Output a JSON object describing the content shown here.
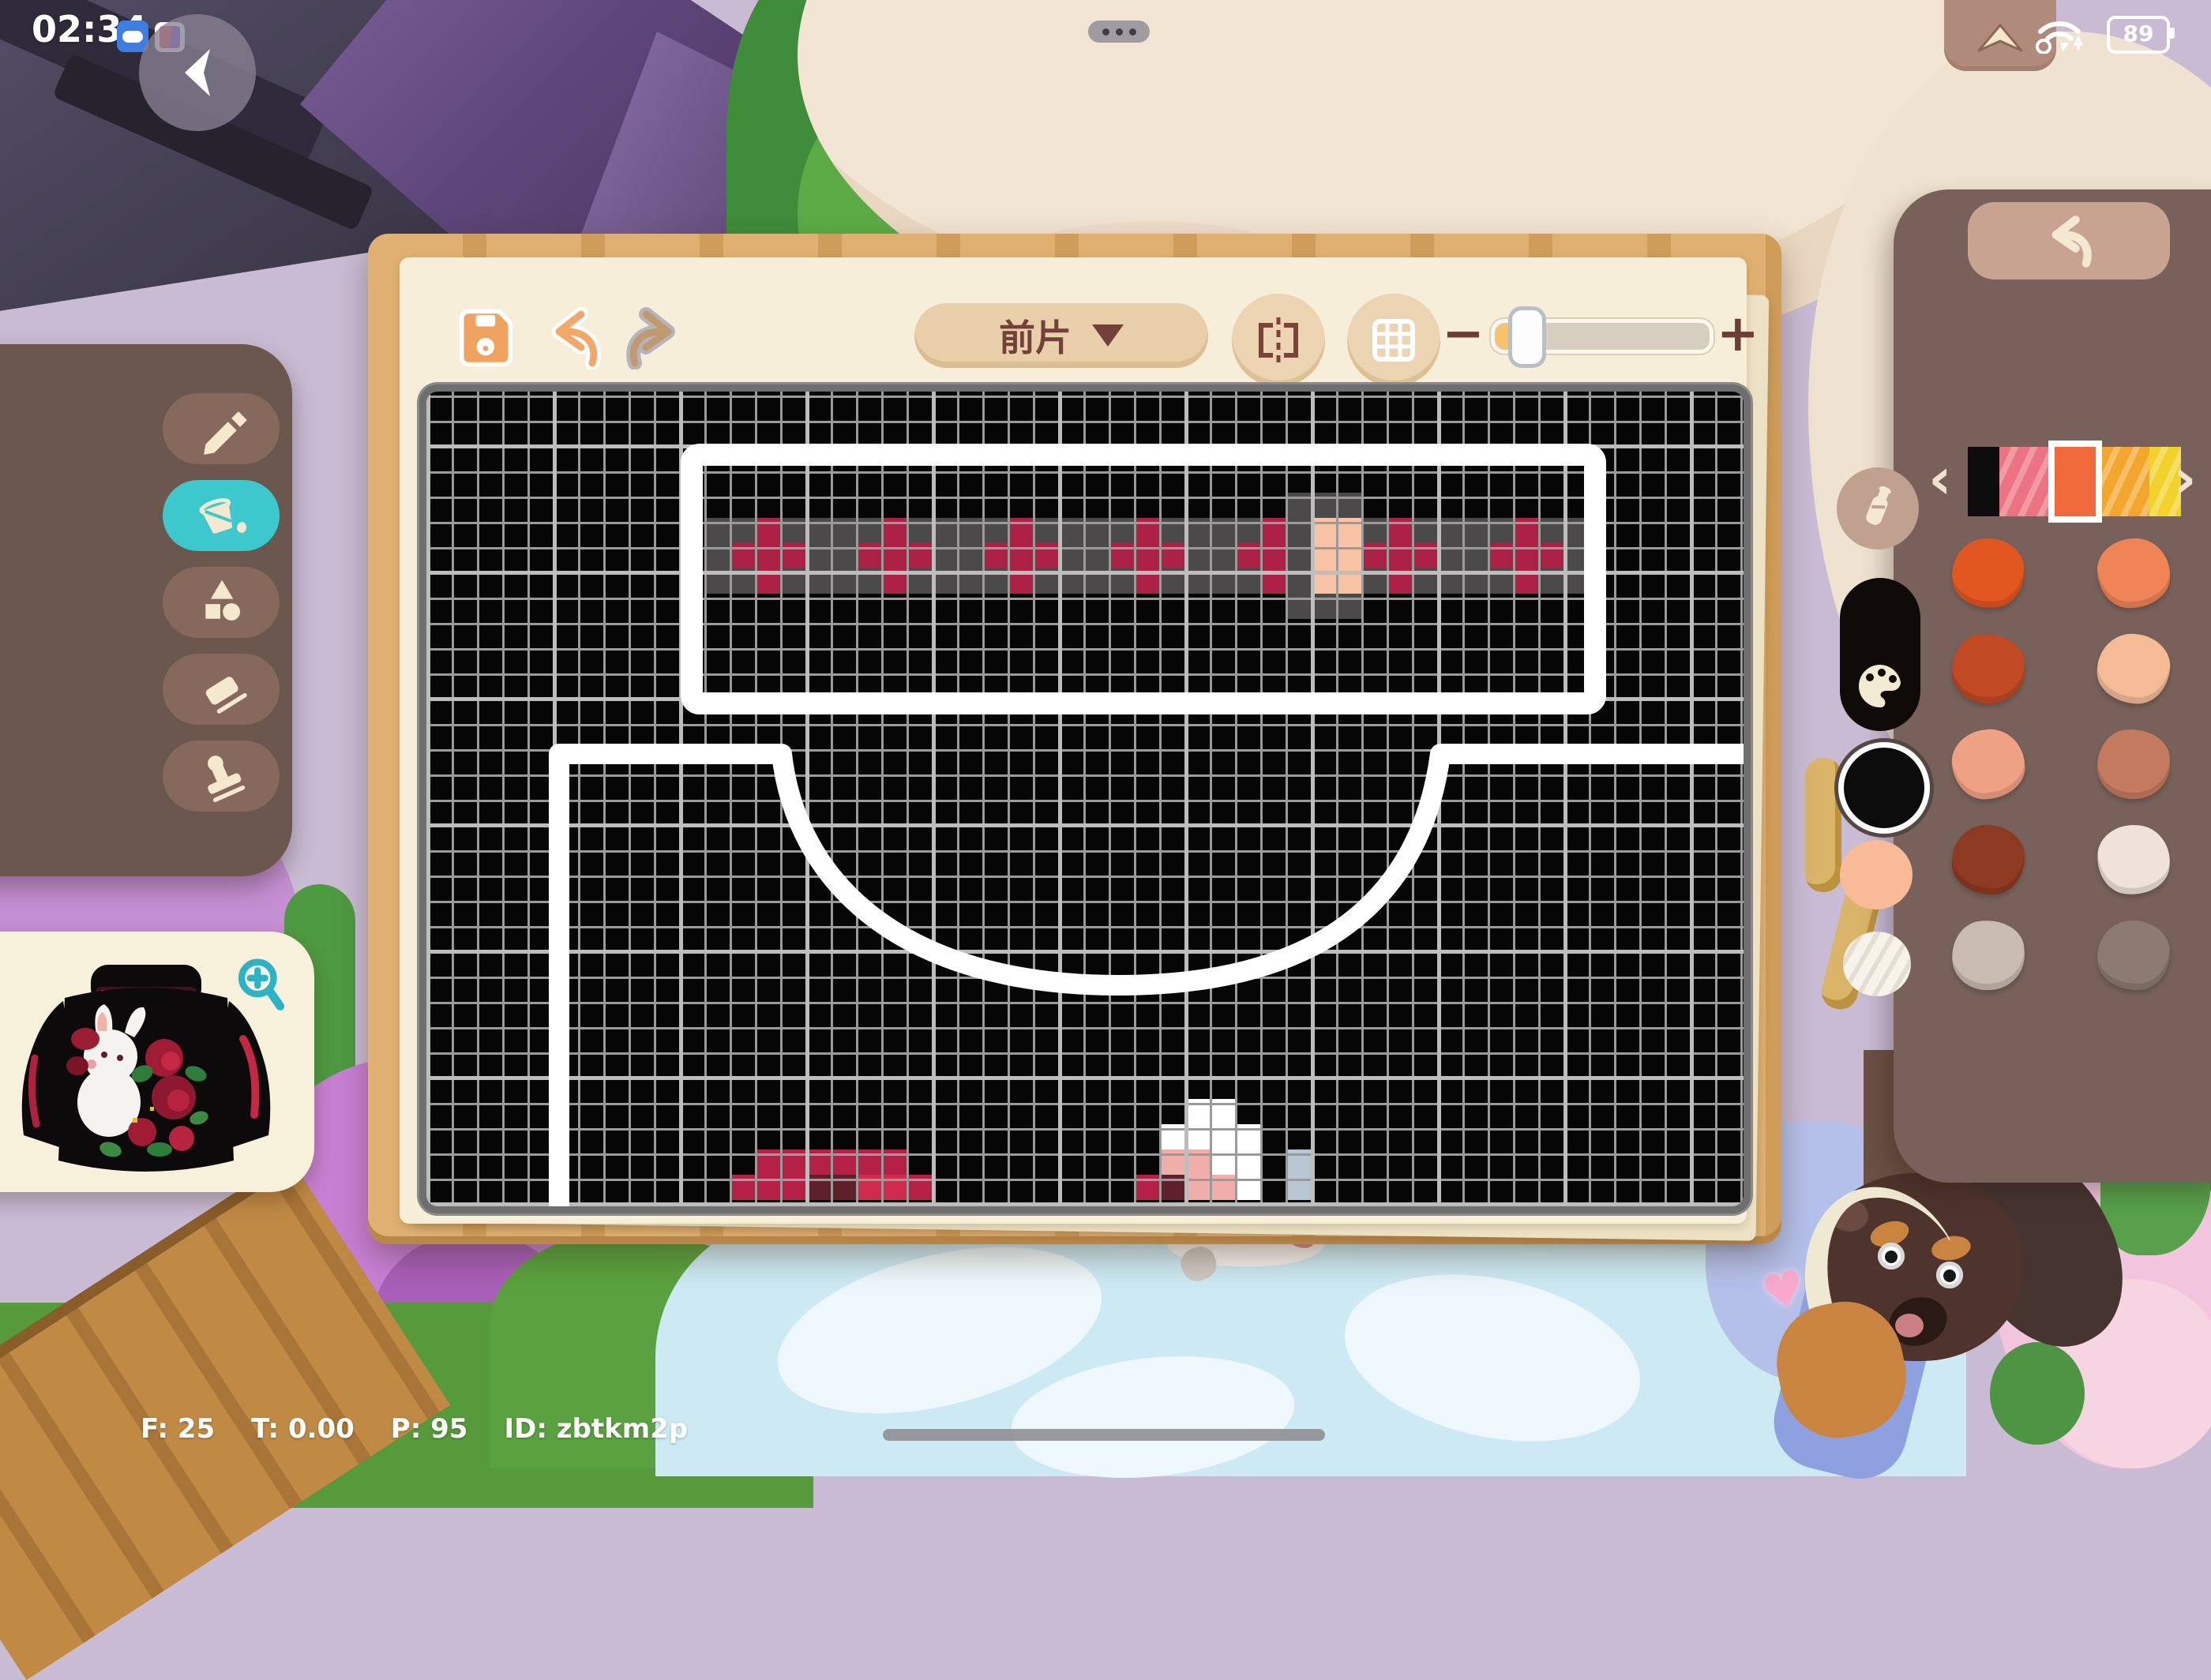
{
  "status_bar": {
    "clock": "02:34",
    "battery_percent": "89",
    "icons": [
      "cloud-app-icon",
      "book-app-icon",
      "back-arrow-icon",
      "multitask-dots-icon",
      "panel-up-icon",
      "wifi-icon",
      "battery-icon"
    ]
  },
  "toolbar": {
    "save_icon": "floppy-save-icon",
    "undo_icon": "undo-arrow-icon",
    "redo_icon": "redo-arrow-icon",
    "piece_selector": {
      "label": "前片",
      "icon": "chevron-down-triangle"
    },
    "mirror_icon": "mirror-symmetry-icon",
    "grid_icon": "grid-toggle-icon",
    "zoom_out_label": "−",
    "zoom_in_label": "+",
    "zoom_slider": {
      "value_fraction": 0.08
    }
  },
  "left_tools": {
    "items": [
      {
        "id": "pencil-tool",
        "selected": false
      },
      {
        "id": "bucket-tool",
        "selected": true
      },
      {
        "id": "shapes-tool",
        "selected": false
      },
      {
        "id": "eraser-tool",
        "selected": false
      },
      {
        "id": "stamp-tool",
        "selected": false
      }
    ],
    "selected_color": "#3cc8cd"
  },
  "preview": {
    "magnifier_icon": "zoom-in-magnifier",
    "subject": "black bunny rose sweater"
  },
  "right_panel": {
    "undo_icon": "undo-arrow-icon",
    "chevron_left": "‹",
    "chevron_right": "›",
    "strip": [
      {
        "color": "#0d0d0d",
        "selected": false,
        "striped": false,
        "w": 40
      },
      {
        "color": "#ec7381",
        "selected": false,
        "striped": true,
        "w": 62
      },
      {
        "color": "#f06a3c",
        "selected": true,
        "striped": false,
        "w": 68
      },
      {
        "color": "#f2a62e",
        "selected": false,
        "striped": true,
        "w": 60
      },
      {
        "color": "#f1d22b",
        "selected": false,
        "striped": true,
        "w": 40
      }
    ],
    "bottle_icon": "milk-bottle-icon",
    "palette_icon": "artist-palette-icon",
    "current_color": "#0c0c0c",
    "quick_colors": [
      "#f9ba97",
      "#f7f3ea"
    ],
    "swatches": [
      "#e2571f",
      "#ef8456",
      "#c14a24",
      "#f5bb97",
      "#efa183",
      "#c47a5e",
      "#8e3a22",
      "#eee2da",
      "#c9bab2",
      "#8d7b71"
    ]
  },
  "canvas": {
    "cell": 32,
    "cols": 52,
    "rows": 32,
    "palette": {
      "g": "#4b4949",
      "r": "#ac2145",
      "p": "#f7c3a4",
      "c": "#b52046",
      "m": "#5f1f2b",
      "b": "#d02a4e",
      "w": "#ffffff",
      "k": "#f0aeaa",
      "u": "#b7c6d2"
    },
    "band": {
      "col0": 11,
      "row0": 4,
      "rows": [
        ".......................ggg.........",
        "ggrggggrggggrggggrggggrgppgrggggrgg",
        "grrrggrrrggrrrggrrrggrrgpprrrggrrrg",
        "ggrggggrggggrggggrggggrgppgrggggrgg",
        ".......................ggg........."
      ]
    },
    "pixels": [
      [
        30,
        13,
        "c"
      ],
      [
        30,
        14,
        "c"
      ],
      [
        30,
        15,
        "c"
      ],
      [
        30,
        16,
        "c"
      ],
      [
        30,
        17,
        "c"
      ],
      [
        30,
        18,
        "c"
      ],
      [
        31,
        12,
        "c"
      ],
      [
        31,
        13,
        "c"
      ],
      [
        31,
        14,
        "c"
      ],
      [
        31,
        15,
        "m"
      ],
      [
        31,
        16,
        "m"
      ],
      [
        31,
        17,
        "b"
      ],
      [
        31,
        18,
        "b"
      ],
      [
        31,
        19,
        "c"
      ],
      [
        28,
        30,
        "w"
      ],
      [
        28,
        31,
        "w"
      ],
      [
        29,
        29,
        "w"
      ],
      [
        29,
        30,
        "w"
      ],
      [
        29,
        31,
        "w"
      ],
      [
        29,
        32,
        "w"
      ],
      [
        30,
        29,
        "k"
      ],
      [
        30,
        30,
        "k"
      ],
      [
        30,
        31,
        "w"
      ],
      [
        30,
        32,
        "w"
      ],
      [
        30,
        34,
        "u"
      ],
      [
        31,
        28,
        "c"
      ],
      [
        31,
        29,
        "m"
      ],
      [
        31,
        30,
        "k"
      ],
      [
        31,
        31,
        "k"
      ],
      [
        31,
        32,
        "w"
      ],
      [
        31,
        34,
        "u"
      ]
    ]
  },
  "debug": {
    "stats": [
      "F: 25",
      "T: 0.00",
      "P: 95",
      "ID: zbtkm2p"
    ]
  },
  "scene": {
    "heart": "♥",
    "accent_teal": "#2db4c4",
    "panel_brown": "#77615a",
    "frame_wood": "#dfb071"
  }
}
